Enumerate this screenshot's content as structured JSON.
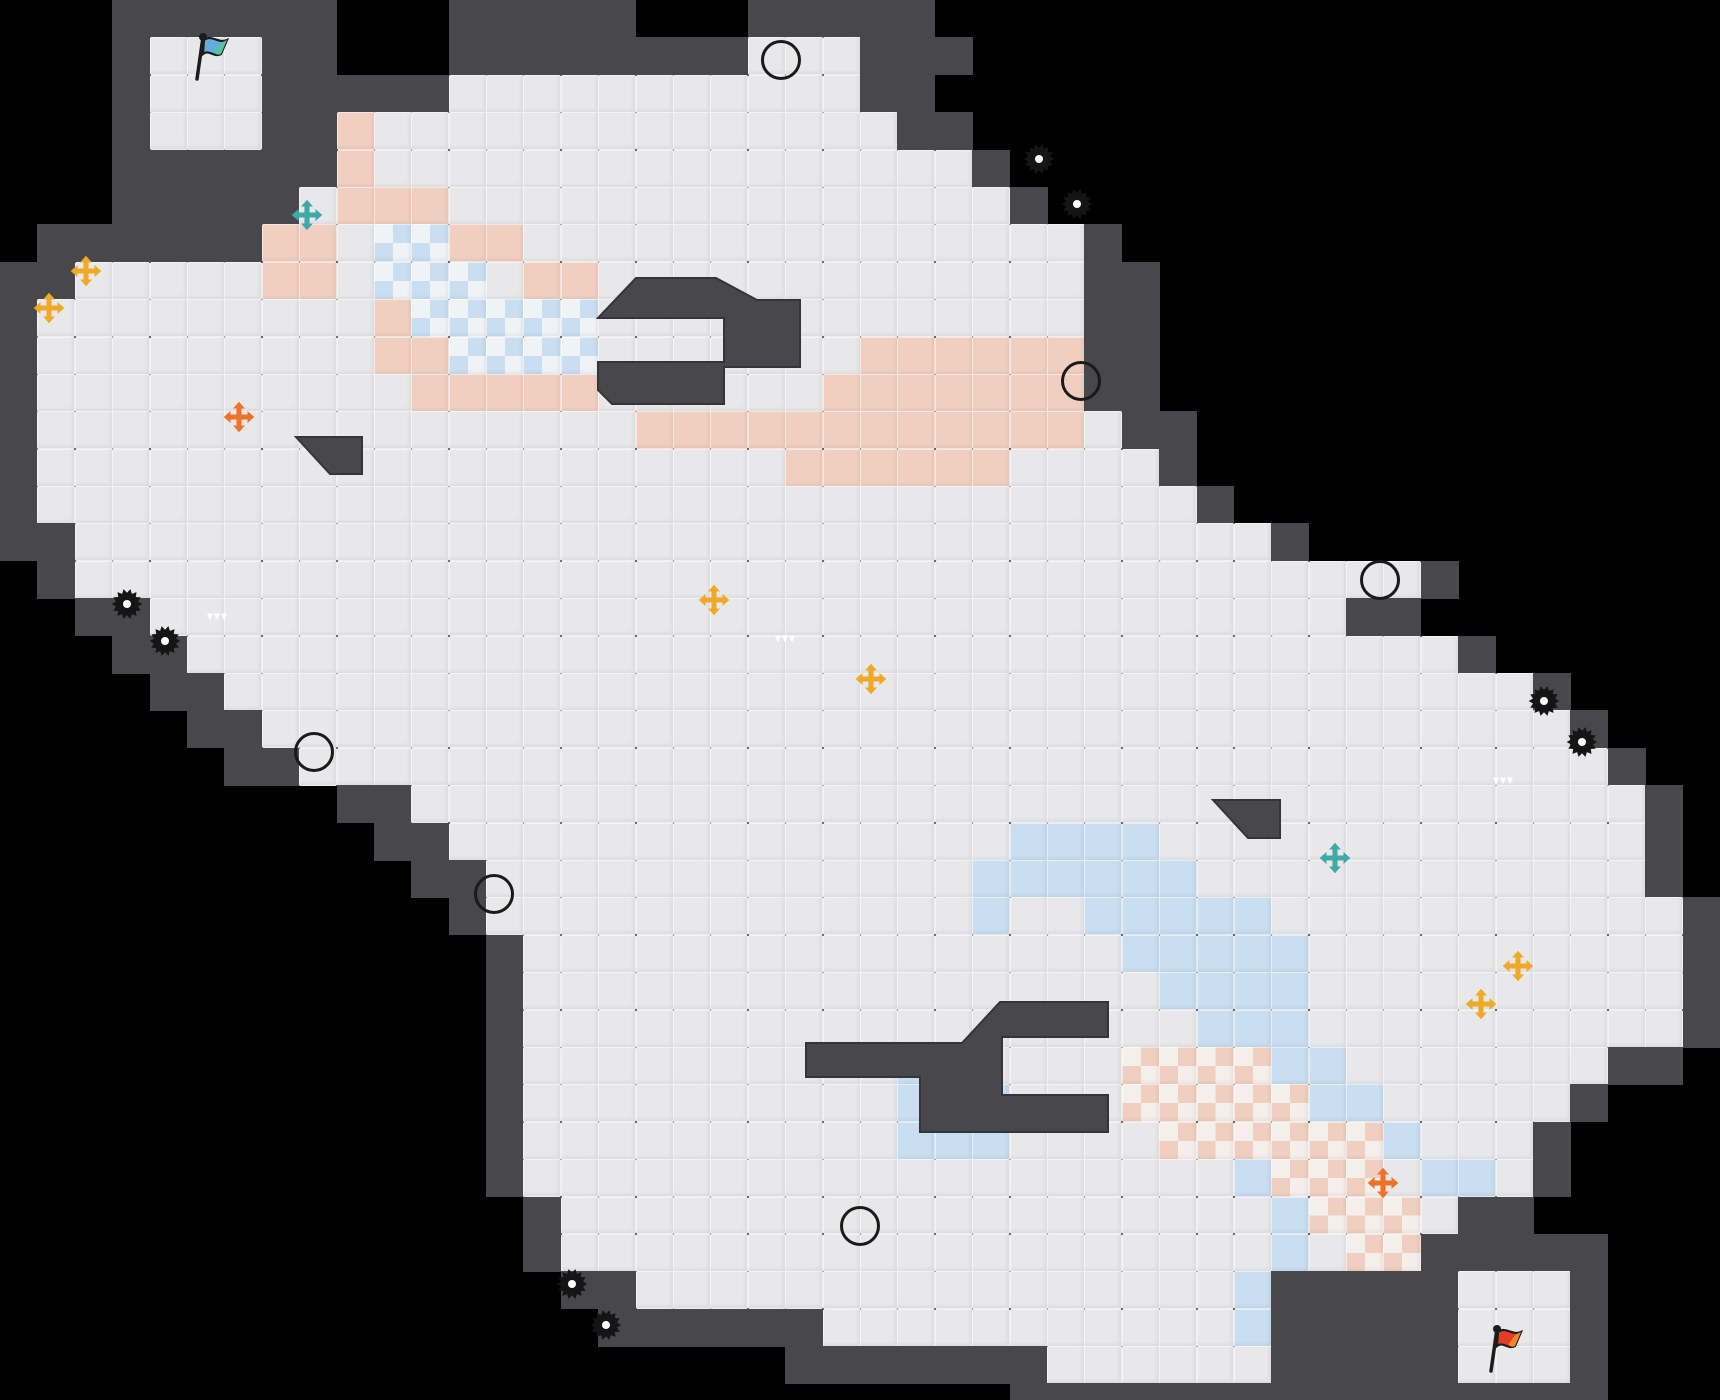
{
  "palette": {
    "void": "#000000",
    "wall": "#47474c",
    "wall_edge": "#34343a",
    "floor": "#e8e8ea",
    "peach": "#f1cfc0",
    "blue": "#c9def0",
    "checker_white": "#f3f0ee",
    "bomb_purple": "#a05b9d",
    "coin_yellow": "#f4c526",
    "orb_green": "#cfe02c",
    "boost_green": "#8ec63f",
    "pale_pad": "#d4d8c5",
    "cross_gold": "#f0a827",
    "cross_orange": "#ee7228",
    "cross_teal": "#3fa9a5",
    "flag_blue": "#64aede",
    "flag_red": "#e33d22",
    "block_gray": "#9b9b9f",
    "gear_black": "#151515"
  },
  "map": {
    "cols": 46,
    "rows": 38,
    "tile_px": 37.391,
    "legend": {
      ".": "floor",
      "W": "wall",
      "X": "void",
      "p": "peach-tile",
      "b": "blue-tile",
      "P": "peach-checker",
      "B": "blue-checker"
    },
    "grid": [
      "XXXWWWWWWXXXWWWWWXXXWWWWWXXXXXXXXXXXXXXXXXXXXX",
      "XXXW...WWXXXWWWWWWWW...WWWXXXXXXXXXXXXXXXXXXXX",
      "XXXW...WWWWW...........WWXXXXXXXXXXXXXXXXXXXXX",
      "XXXW...WWp..............WWXXXXXXXXXXXXXXXXXXXX",
      "XXXWWWWWWp................WXXXXXXXXXXXXXXXXXXX",
      "XXXWWWWW.ppp...............WXXXXXXXXXXXXXXXXXX",
      "XWWWWWWpp.BBpp...............WXXXXXXXXXXXXXXXX",
      "WW.....pp.BBB.pp.............WWXXXXXXXXXXXXXXX",
      "W.........pBBBBB.............WWXXXXXXXXXXXXXXX",
      "W.........ppBBBB.......ppppppWWXXXXXXXXXXXXXXX",
      "W..........ppppp......pppppppWWXXXXXXXXXXXXXXX",
      "W................pppppppppppp.WWXXXXXXXXXXXXXX",
      "W....................pppppp....WXXXXXXXXXXXXXX",
      "W...............................WXXXXXXXXXXXXX",
      "WW................................WXXXXXXXXXXX",
      "XW....................................WXXXXXXX",
      "XXWW................................WWXXXXXXXX",
      "XXXWW..................................WXXXXXX",
      "XXXXWW...................................WXXXX",
      "XXXXXWW...................................WXXX",
      "XXXXXXWW...................................WXX",
      "XXXXXXXXXWW.................................WX",
      "XXXXXXXXXXWW...............bbbb.............WX",
      "XXXXXXXXXXXWW.............bbbbbb............WX",
      "XXXXXXXXXXXXW.............b..bbbbb...........W",
      "XXXXXXXXXXXXXW................bbbbb..........W",
      "XXXXXXXXXXXXXW.................bbbb..........W",
      "XXXXXXXXXXXXXW..................bbb..........W",
      "XXXXXXXXXXXXXW..........bb....PPPPbb.......WWX",
      "XXXXXXXXXXXXXW..........bbb...PPPPPbb.....WXXX",
      "XXXXXXXXXXXXXW..........bbb....PPPPPPb...WXXXX",
      "XXXXXXXXXXXXXW...................bPPP.bb.WXXXX",
      "XXXXXXXXXXXXXXW...................bPPP.WWXXXXX",
      "XXXXXXXXXXXXXXW...................b.PPWWWWWXXX",
      "XXXXXXXXXXXXXXXWW................bWWWWW...WXXX",
      "XXXXXXXXXXXXXXXXWWWWWW...........bWWWWW...WXXX",
      "XXXXXXXXXXXXXXXXXXXXXWWWWWWW......WWWWW...WXXX",
      "XXXXXXXXXXXXXXXXXXXXXXXXXXXWWWWWWWWWWWWWWWWXXX"
    ]
  },
  "structures": {
    "pocket_top": [
      [
        598,
        318
      ],
      [
        636,
        278
      ],
      [
        716,
        278
      ],
      [
        757,
        300
      ],
      [
        800,
        300
      ],
      [
        800,
        367
      ],
      [
        724,
        367
      ],
      [
        724,
        404
      ],
      [
        612,
        404
      ],
      [
        598,
        390
      ],
      [
        598,
        362
      ],
      [
        724,
        362
      ],
      [
        724,
        318
      ]
    ],
    "pocket_bottom": [
      [
        806,
        1043
      ],
      [
        962,
        1043
      ],
      [
        1000,
        1002
      ],
      [
        1108,
        1002
      ],
      [
        1108,
        1037
      ],
      [
        1002,
        1037
      ],
      [
        1002,
        1095
      ],
      [
        1108,
        1095
      ],
      [
        1108,
        1132
      ],
      [
        920,
        1132
      ],
      [
        920,
        1077
      ],
      [
        806,
        1077
      ]
    ],
    "wedge_left": [
      [
        296,
        437
      ],
      [
        362,
        437
      ],
      [
        362,
        474
      ],
      [
        330,
        474
      ]
    ],
    "wedge_right": [
      [
        1213,
        800
      ],
      [
        1280,
        800
      ],
      [
        1280,
        838
      ],
      [
        1248,
        838
      ]
    ]
  },
  "items": [
    {
      "type": "bomb",
      "x": 20.9,
      "y": 1.6
    },
    {
      "type": "bomb",
      "x": 28.9,
      "y": 10.2
    },
    {
      "type": "bomb",
      "x": 36.9,
      "y": 15.5
    },
    {
      "type": "bomb",
      "x": 8.4,
      "y": 20.1
    },
    {
      "type": "bomb",
      "x": 13.2,
      "y": 23.9
    },
    {
      "type": "bomb",
      "x": 23.0,
      "y": 32.8
    },
    {
      "type": "coin",
      "x": 13.2,
      "y": 3.4
    },
    {
      "type": "coin",
      "x": 14.2,
      "y": 13.2
    },
    {
      "type": "coin",
      "x": 7.3,
      "y": 18.1
    },
    {
      "type": "coin",
      "x": 8.3,
      "y": 18.1
    },
    {
      "type": "coin",
      "x": 9.3,
      "y": 18.1
    },
    {
      "type": "coin",
      "x": 35.9,
      "y": 17.6
    },
    {
      "type": "coin",
      "x": 37.0,
      "y": 17.6
    },
    {
      "type": "coin",
      "x": 38.0,
      "y": 17.6
    },
    {
      "type": "coin",
      "x": 27.9,
      "y": 21.1
    },
    {
      "type": "coin",
      "x": 28.8,
      "y": 30.8
    },
    {
      "type": "gear",
      "x": 27.8,
      "y": 4.3
    },
    {
      "type": "gear",
      "x": 28.8,
      "y": 5.5
    },
    {
      "type": "gear",
      "x": 3.4,
      "y": 16.2
    },
    {
      "type": "gear",
      "x": 4.4,
      "y": 17.2
    },
    {
      "type": "gear",
      "x": 41.3,
      "y": 18.8
    },
    {
      "type": "gear",
      "x": 42.3,
      "y": 19.9
    },
    {
      "type": "gear",
      "x": 15.3,
      "y": 34.4
    },
    {
      "type": "gear",
      "x": 16.2,
      "y": 35.5
    },
    {
      "type": "cross",
      "color": "gold",
      "x": 2.3,
      "y": 7.3
    },
    {
      "type": "cross",
      "color": "gold",
      "x": 1.3,
      "y": 8.3
    },
    {
      "type": "cross",
      "color": "gold",
      "x": 19.1,
      "y": 16.1
    },
    {
      "type": "cross",
      "color": "gold",
      "x": 23.3,
      "y": 18.2
    },
    {
      "type": "cross",
      "color": "gold",
      "x": 40.6,
      "y": 25.9
    },
    {
      "type": "cross",
      "color": "gold",
      "x": 39.6,
      "y": 26.9
    },
    {
      "type": "cross",
      "color": "orange",
      "x": 6.4,
      "y": 11.2
    },
    {
      "type": "cross",
      "color": "orange",
      "x": 37.0,
      "y": 31.7
    },
    {
      "type": "cross",
      "color": "teal",
      "x": 8.2,
      "y": 5.8
    },
    {
      "type": "cross",
      "color": "teal",
      "x": 35.7,
      "y": 23.0
    },
    {
      "type": "boost",
      "x": 5.8,
      "y": 16.5
    },
    {
      "type": "boost",
      "x": 21.0,
      "y": 17.1
    },
    {
      "type": "boost",
      "x": 40.2,
      "y": 20.9
    },
    {
      "type": "pale",
      "x": 4.5,
      "y": 1.5
    },
    {
      "type": "pale",
      "x": 19.0,
      "y": 6.3
    },
    {
      "type": "pale",
      "x": 3.3,
      "y": 9.2
    },
    {
      "type": "pale",
      "x": 6.8,
      "y": 22.8
    },
    {
      "type": "pale",
      "x": 37.7,
      "y": 24.9
    },
    {
      "type": "pale",
      "x": 22.9,
      "y": 27.8
    },
    {
      "type": "pale",
      "x": 41.5,
      "y": 36.4
    },
    {
      "type": "orb",
      "x": 4.5,
      "y": 3.5
    },
    {
      "type": "orb",
      "x": 5.5,
      "y": 3.5
    },
    {
      "type": "orb",
      "x": 6.5,
      "y": 3.5
    },
    {
      "type": "orb",
      "x": 18.75,
      "y": 9.1
    },
    {
      "type": "orb",
      "x": 27.4,
      "y": 28.4
    },
    {
      "type": "orb",
      "x": 39.5,
      "y": 34.5
    },
    {
      "type": "orb",
      "x": 40.5,
      "y": 34.5
    },
    {
      "type": "orb",
      "x": 41.5,
      "y": 34.5
    },
    {
      "type": "square",
      "color": "red",
      "x": 17.7,
      "y": 9.1
    },
    {
      "type": "square",
      "color": "teal",
      "x": 28.6,
      "y": 28.6
    },
    {
      "type": "flag",
      "color": "blue",
      "x": 5.6,
      "y": 1.55
    },
    {
      "type": "flag",
      "color": "red",
      "x": 40.2,
      "y": 36.1
    },
    {
      "type": "tick",
      "dir": "v",
      "x": 8.0,
      "y": 4.5
    },
    {
      "type": "tick",
      "dir": "dot",
      "x": 19.76,
      "y": 9.57
    },
    {
      "type": "tick",
      "dir": "v",
      "x": 30.6,
      "y": 11.0
    },
    {
      "type": "tick",
      "dir": "v",
      "x": 38.0,
      "y": 16.3
    },
    {
      "type": "tick",
      "dir": "v",
      "x": 10.3,
      "y": 23.3
    },
    {
      "type": "tick",
      "dir": "v",
      "x": 39.5,
      "y": 32.4
    },
    {
      "type": "tick",
      "dir": "v",
      "x": 38.0,
      "y": 35.5
    },
    {
      "type": "tick",
      "dir": "v",
      "x": 42.3,
      "y": 36.6
    },
    {
      "type": "block",
      "style": "dotted",
      "x": 15.05,
      "y": 3.35
    },
    {
      "type": "block",
      "style": "dotted",
      "x": 16.1,
      "y": 4.35
    },
    {
      "type": "block",
      "style": "dotted",
      "x": 16.8,
      "y": 15.1
    },
    {
      "type": "block",
      "style": "dotted",
      "x": 17.8,
      "y": 15.1
    },
    {
      "type": "block",
      "style": "dark",
      "x": 15.25,
      "y": 16.15
    },
    {
      "type": "block",
      "style": "dotted",
      "x": 16.3,
      "y": 16.15
    },
    {
      "type": "block",
      "style": "dotted",
      "x": 17.3,
      "y": 16.15
    },
    {
      "type": "block",
      "style": "dotted",
      "x": 18.3,
      "y": 16.15
    },
    {
      "type": "block",
      "style": "dotted",
      "x": 24.7,
      "y": 18.2
    },
    {
      "type": "block",
      "style": "dotted",
      "x": 25.7,
      "y": 18.2
    },
    {
      "type": "block",
      "style": "dotted",
      "x": 26.7,
      "y": 18.2
    },
    {
      "type": "block",
      "style": "dark",
      "x": 27.7,
      "y": 18.2
    },
    {
      "type": "block",
      "style": "dotted",
      "x": 23.7,
      "y": 19.25
    },
    {
      "type": "block",
      "style": "dotted",
      "x": 24.7,
      "y": 19.25
    },
    {
      "type": "block",
      "style": "dotted",
      "x": 25.7,
      "y": 19.25
    },
    {
      "type": "block",
      "style": "dark",
      "x": 26.7,
      "y": 19.25
    },
    {
      "type": "block",
      "style": "dotted",
      "x": 26.2,
      "y": 29.9
    },
    {
      "type": "block",
      "style": "dotted",
      "x": 27.2,
      "y": 30.9
    }
  ]
}
